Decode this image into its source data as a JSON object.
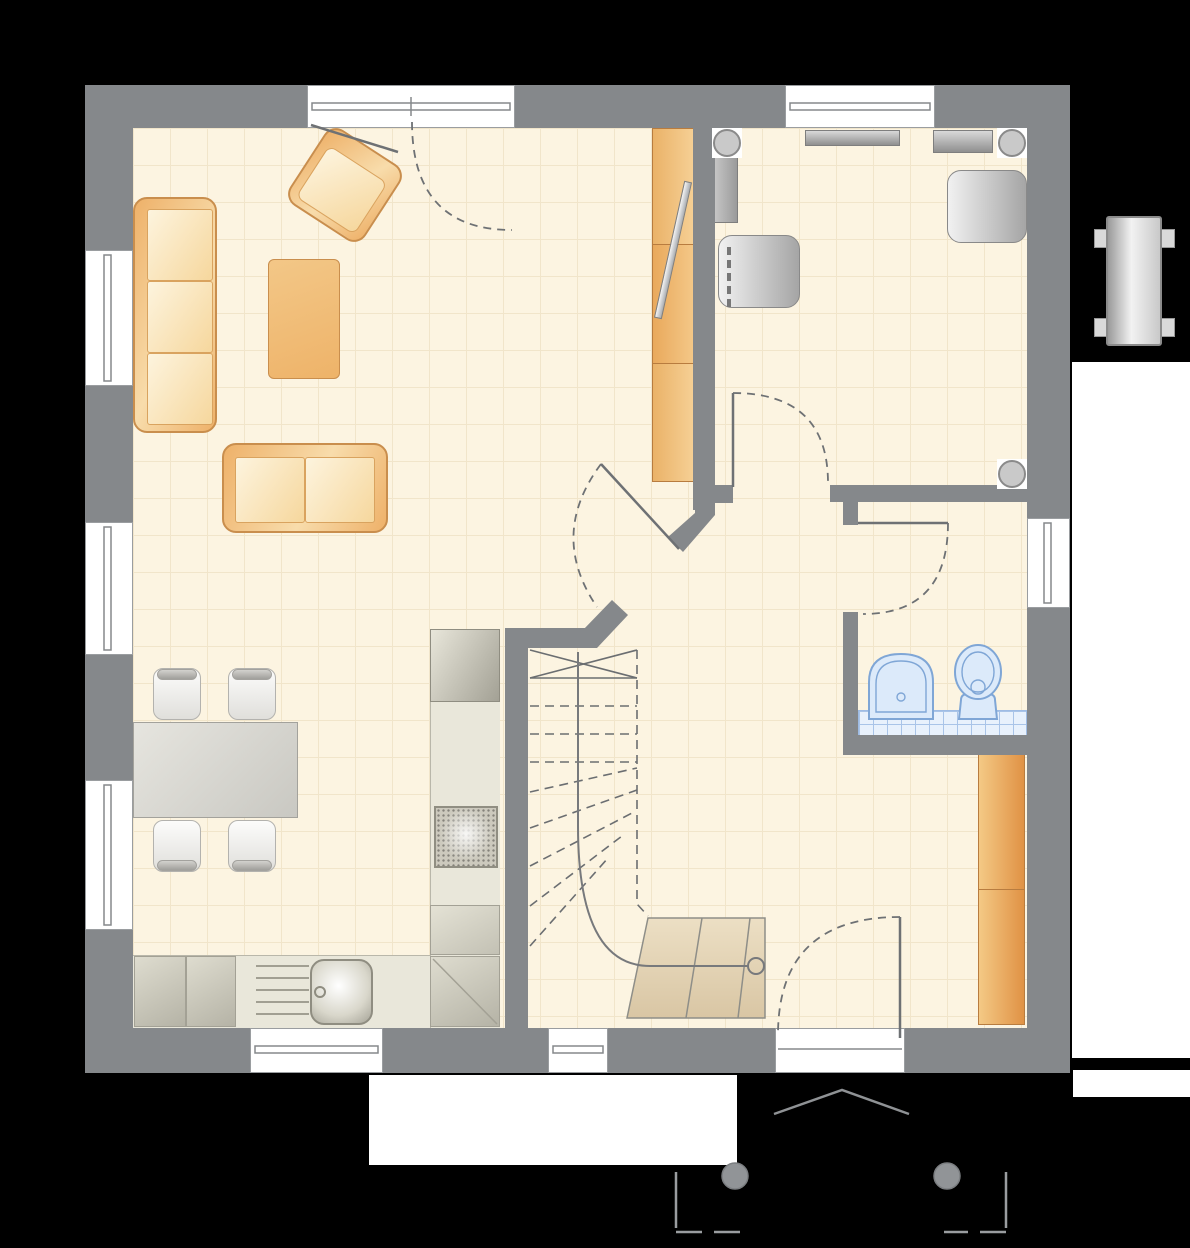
{
  "meta": {
    "description": "Ground-floor architectural plan of a small house, top-down view, no text labels",
    "view": "floor-plan"
  },
  "colors": {
    "background": "#000000",
    "wall": "#85888b",
    "floor": "#fcf4e1",
    "floor_grid": "#f1e5ca",
    "outdoor_white": "#ffffff",
    "furniture_orange_border": "#c98e4d",
    "furniture_orange": "#eeb169",
    "furniture_orange_light": "#f8dcab",
    "cushion": "#fdf4de",
    "kitchen_counter": "#e9e7da",
    "gray_furniture_light": "#f1f1f1",
    "gray_furniture_dark": "#a5a5a5",
    "bath_fixture_fill": "#dceafa",
    "bath_fixture_stroke": "#7fa6d6",
    "tile": "#e8f1fc",
    "stair_steps_light": "#ecdfc4",
    "stair_steps_dark": "#d9c6a4",
    "linework": "#6e7174"
  },
  "plan": {
    "rooms": [
      {
        "name": "living-room",
        "furniture": [
          "sofa-3-seat",
          "sofa-2-seat",
          "armchair",
          "coffee-table",
          "tv-sideboard",
          "tv-panel"
        ]
      },
      {
        "name": "dining-kitchen",
        "furniture": [
          "dining-table",
          "chair",
          "chair",
          "chair",
          "chair",
          "kitchen-counter-l-shape",
          "sink",
          "drainer",
          "cooktop",
          "tall-appliance",
          "base-cabinets"
        ]
      },
      {
        "name": "bedroom-office",
        "furniture": [
          "radiator-shelf",
          "sideboard",
          "wall-shelf",
          "upholstered-chair",
          "upholstered-chair",
          "corner-post",
          "corner-post",
          "corner-post"
        ]
      },
      {
        "name": "bathroom",
        "fixtures": [
          "washbasin",
          "toilet",
          "tiled-splash-strip"
        ]
      },
      {
        "name": "hallway",
        "furniture": [
          "wardrobe-2-door"
        ]
      },
      {
        "name": "staircase",
        "elements": [
          "winder-stair-dashed-upper-run",
          "solid-first-steps",
          "walk-line-with-start-circle"
        ]
      }
    ],
    "openings": {
      "windows": [
        "left-window-1",
        "left-window-2",
        "left-window-3",
        "top-bedroom-window",
        "bottom-kitchen-window",
        "bottom-stair-window",
        "right-bathroom-window"
      ],
      "doors": [
        "terrace-french-door",
        "living-room-diagonal-door",
        "bedroom-door",
        "bathroom-door",
        "entrance-door"
      ]
    },
    "outside": [
      "terrace-slab",
      "garden-white-strip",
      "rear-path",
      "entrance-porch-two-columns",
      "canopy-chevron",
      "chimney-unit"
    ]
  }
}
